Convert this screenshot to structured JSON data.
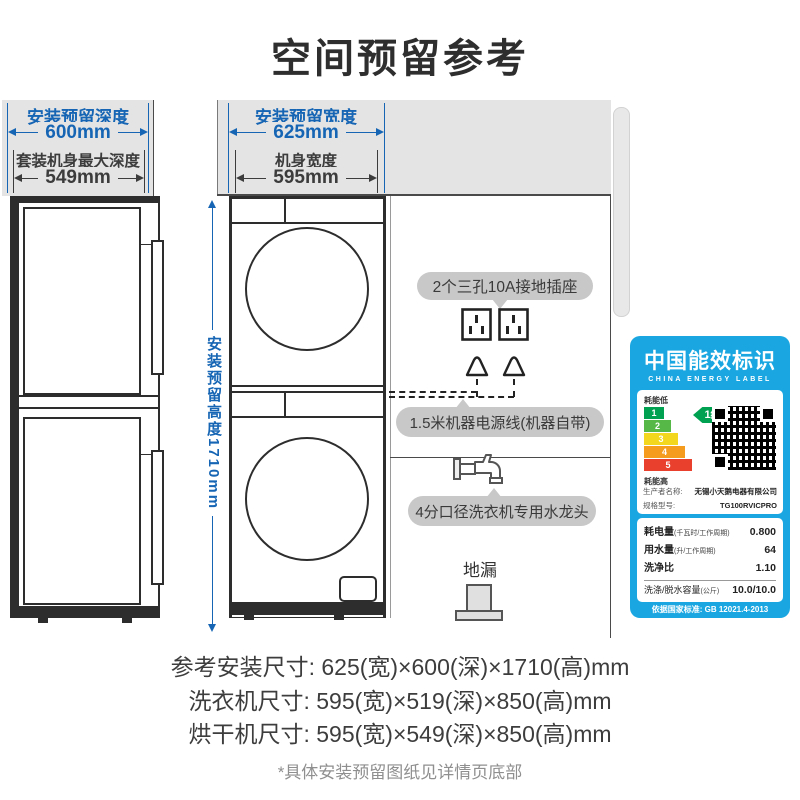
{
  "title": "空间预留参考",
  "side_view": {
    "reserve_depth_label": "安装预留深度",
    "reserve_depth_value": "600mm",
    "body_depth_label": "套装机身最大深度",
    "body_depth_value": "549mm"
  },
  "front_view": {
    "reserve_width_label": "安装预留宽度",
    "reserve_width_value": "625mm",
    "body_width_label": "机身宽度",
    "body_width_value": "595mm",
    "reserve_height_label": "安装预留高度1710mm"
  },
  "annotations": {
    "sockets": "2个三孔10A接地插座",
    "power_cord": "1.5米机器电源线(机器自带)",
    "water_tap": "4分口径洗衣机专用水龙头",
    "floor_drain": "地漏"
  },
  "energy_label": {
    "title_cn": "中国能效标识",
    "title_en": "CHINA ENERGY LABEL",
    "energy_low": "耗能低",
    "energy_high": "耗能高",
    "grade_badge": "1级",
    "grades": [
      "1",
      "2",
      "3",
      "4",
      "5"
    ],
    "producer_label": "生产者名称:",
    "producer": "无锡小天鹅电器有限公司",
    "model_label": "规格型号:",
    "model": "TG100RVICPRO",
    "metrics": [
      {
        "label": "耗电量",
        "unit": "(千瓦时/工作周期)",
        "value": "0.800"
      },
      {
        "label": "用水量",
        "unit": "(升/工作周期)",
        "value": "64"
      },
      {
        "label": "洗净比",
        "unit": "",
        "value": "1.10"
      },
      {
        "label": "洗涤/脱水容量",
        "unit": "(公斤)",
        "value": "10.0/10.0"
      }
    ],
    "standard": "依据国家标准: GB 12021.4-2013"
  },
  "footer": {
    "install_size": "参考安装尺寸: 625(宽)×600(深)×1710(高)mm",
    "washer_size": "洗衣机尺寸: 595(宽)×519(深)×850(高)mm",
    "dryer_size": "烘干机尺寸: 595(宽)×549(深)×850(高)mm",
    "note": "*具体安装预留图纸见详情页底部"
  },
  "colors": {
    "dimension_blue": "#1565b4",
    "energy_label_blue": "#1aa7e1",
    "grade1_green": "#00a251"
  }
}
